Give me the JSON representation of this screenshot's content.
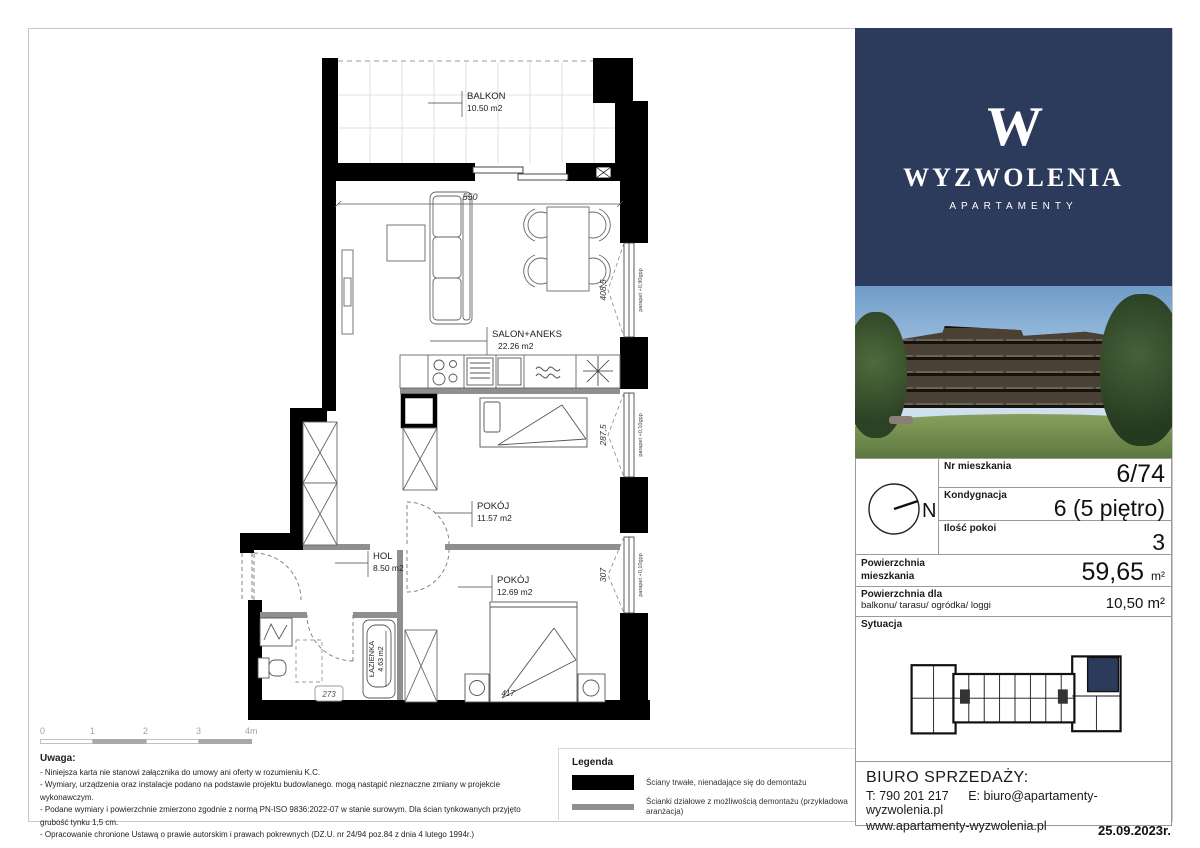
{
  "page": {
    "date": "25.09.2023r."
  },
  "logo": {
    "monogram": "W",
    "name": "WYZWOLENIA",
    "subtitle": "APARTAMENTY"
  },
  "colors": {
    "navy": "#2c3a5b",
    "wall_black": "#000000",
    "partition_gray": "#8f8f8f",
    "border_gray": "#c8c8c8"
  },
  "plan": {
    "balkon": {
      "name": "BALKON",
      "area": "10.50 m2"
    },
    "salon": {
      "name": "SALON+ANEKS",
      "area": "22.26 m2"
    },
    "pokoj1": {
      "name": "POKÓJ",
      "area": "11.57 m2"
    },
    "pokoj2": {
      "name": "POKÓJ",
      "area": "12.69 m2"
    },
    "hol": {
      "name": "HOL",
      "area": "8.50 m2"
    },
    "lazienka": {
      "name": "ŁAZIENKA",
      "area": "4.63 m2"
    },
    "dims": {
      "salon_width": "550",
      "salon_window": "408,5",
      "pokoj1_window": "287,5",
      "pokoj2_window": "307",
      "bed": "417",
      "door": "273"
    },
    "parapet_salon": "parapet +0,90gpp",
    "parapet_low": "parapet +0,10gpp"
  },
  "scalebar": {
    "labels": [
      "0",
      "1",
      "2",
      "3",
      "4m"
    ]
  },
  "notes": {
    "title": "Uwaga:",
    "items": [
      "- Niniejsza karta nie stanowi załącznika do umowy ani oferty w rozumieniu K.C.",
      "- Wymiary, urządzenia oraz instalacje podano na podstawie projektu budowlanego. mogą nastąpić  nieznaczne zmiany w projekcie wykonawczym.",
      "- Podane wymiary i powierzchnie zmierzono zgodnie z normą PN-ISO 9836:2022-07 w stanie surowym. Dla ścian tynkowanych przyjęto grubość tynku 1,5 cm.",
      "- Opracowanie chronione Ustawą o prawie autorskim i prawach pokrewnych (DZ.U. nr 24/94 poz.84 z dnia 4 lutego 1994r.)"
    ]
  },
  "legend": {
    "title": "Legenda",
    "items": [
      {
        "swatch": "black",
        "label": "Ściany trwałe, nienadające się do demontażu"
      },
      {
        "swatch": "gray",
        "label": "Ścianki działowe z możliwością demontażu (przykładowa aranżacja)"
      }
    ]
  },
  "compass": {
    "north": "N"
  },
  "info": {
    "rows": [
      {
        "label": "Nr mieszkania",
        "value": "6/74"
      },
      {
        "label": "Kondygnacja",
        "value": "6 (5 piętro)"
      },
      {
        "label": "Ilość pokoi",
        "value": "3"
      }
    ],
    "area_label1": "Powierzchnia",
    "area_label2": "mieszkania",
    "area_value": "59,65",
    "area_unit": "m²",
    "balcony_label1": "Powierzchnia dla",
    "balcony_label2": "balkonu/ tarasu/ ogródka/ loggi",
    "balcony_value": "10,50 m²",
    "situation_label": "Sytuacja"
  },
  "office": {
    "title": "BIURO SPRZEDAŻY:",
    "phone": "T: 790 201 217",
    "email": "E: biuro@apartamenty-wyzwolenia.pl",
    "web": "www.apartamenty-wyzwolenia.pl"
  }
}
